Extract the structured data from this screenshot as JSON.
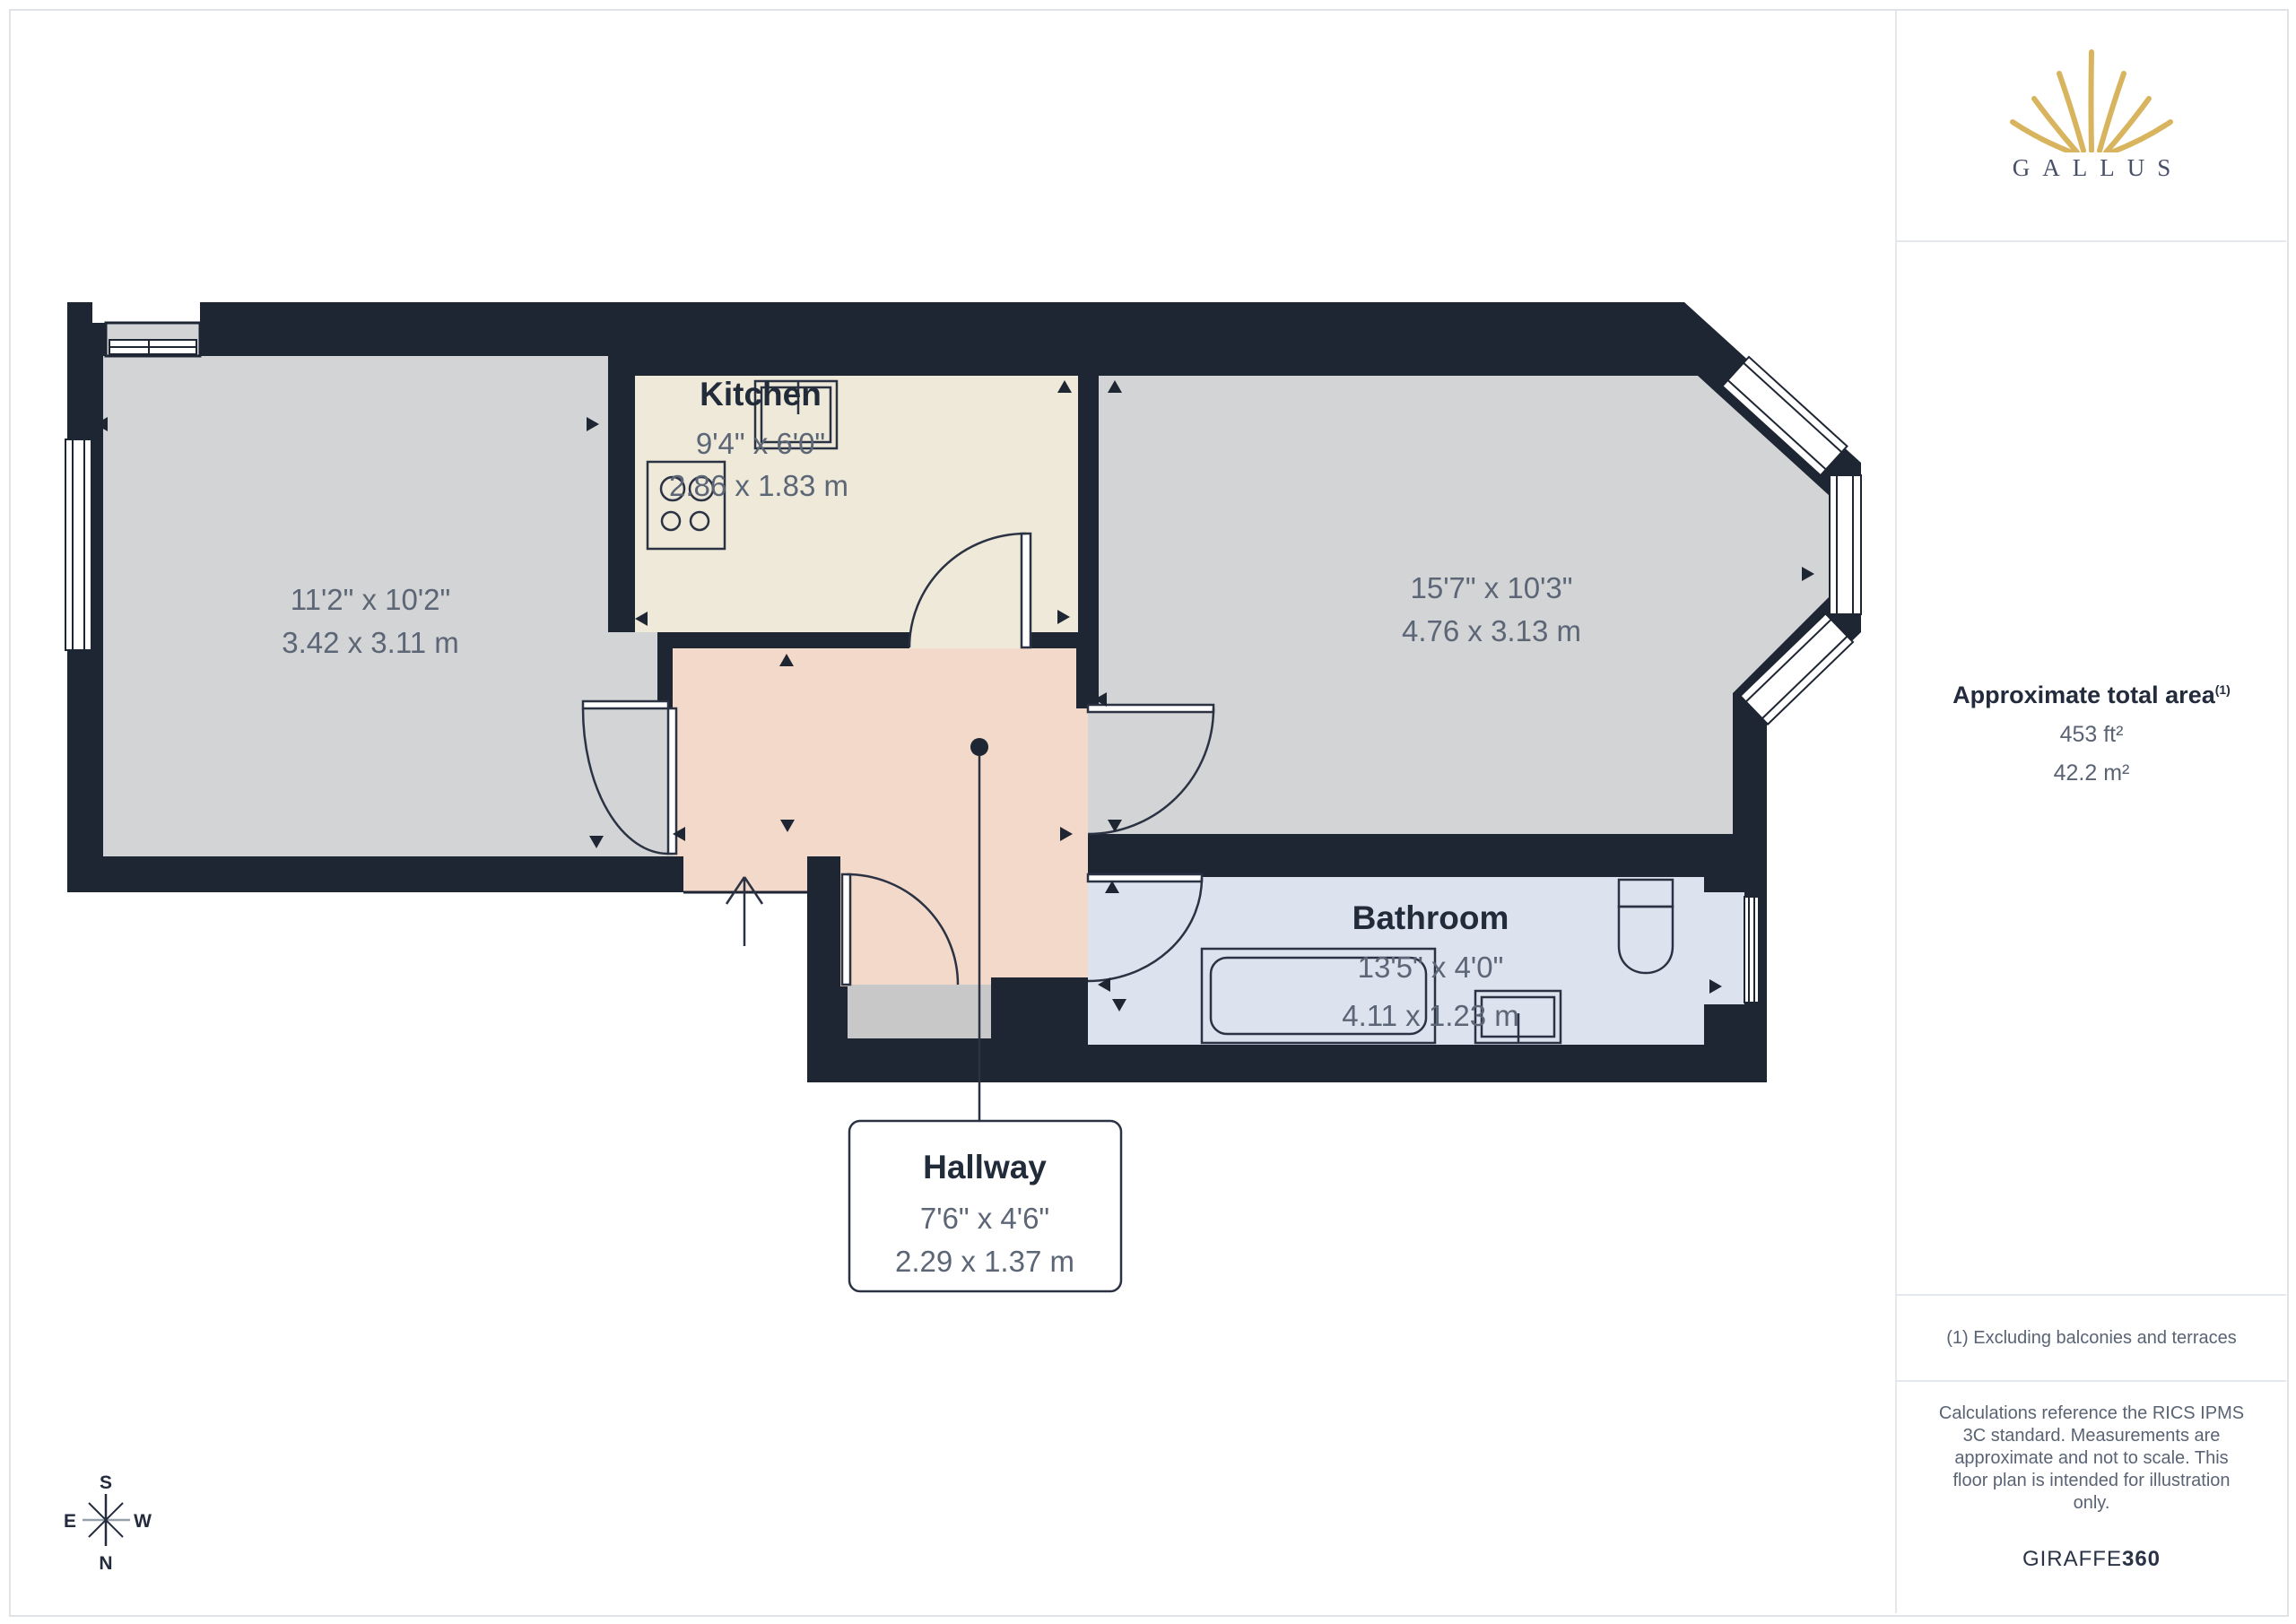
{
  "colors": {
    "wall": "#1e2533",
    "room_gray": "#d3d4d5",
    "kitchen_cream": "#eee9d8",
    "hallway_salmon": "#f3d9c9",
    "bathroom_blue": "#dce2ee",
    "threshold_gray": "#c8c8c8",
    "logo_gold": "#d9b45e",
    "dim_text": "#5c6676",
    "title_text": "#222b3a"
  },
  "rooms": {
    "living": {
      "dim_imperial": "11'2\" x 10'2\"",
      "dim_metric": "3.42 x 3.11 m"
    },
    "kitchen": {
      "label": "Kitchen",
      "dim_imperial": "9'4\" x 6'0\"",
      "dim_metric": "2.86 x 1.83 m"
    },
    "reception": {
      "dim_imperial": "15'7\" x 10'3\"",
      "dim_metric": "4.76 x 3.13 m"
    },
    "bathroom": {
      "label": "Bathroom",
      "dim_imperial": "13'5\" x 4'0\"",
      "dim_metric": "4.11 x 1.23 m"
    },
    "hallway": {
      "label": "Hallway",
      "dim_imperial": "7'6\" x 4'6\"",
      "dim_metric": "2.29 x 1.37 m"
    }
  },
  "sidebar": {
    "logo_brand": "GALLUS",
    "area_heading": "Approximate total area",
    "area_footnote_marker": "(1)",
    "area_imperial": "453 ft²",
    "area_metric": "42.2 m²",
    "footnote": "(1) Excluding balconies and terraces",
    "disclaimer_lines": [
      "Calculations reference the RICS IPMS",
      "3C standard. Measurements are",
      "approximate and not to scale. This",
      "floor plan is intended for illustration",
      "only."
    ],
    "brand_regular": "GIRAFFE",
    "brand_bold": "360"
  },
  "compass": {
    "top": "S",
    "bottom": "N",
    "left": "E",
    "right": "W"
  }
}
